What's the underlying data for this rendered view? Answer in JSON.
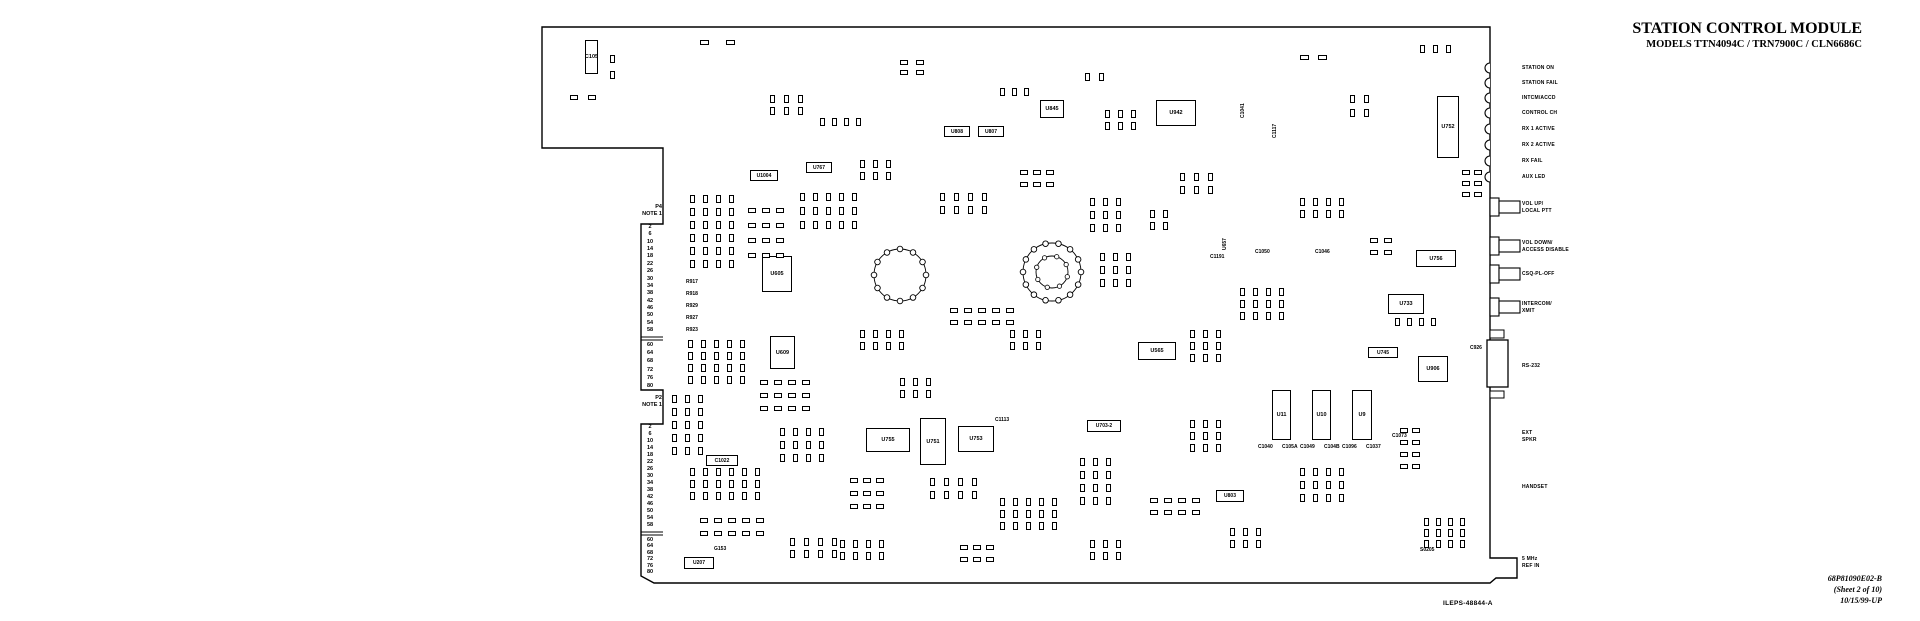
{
  "title": {
    "line1": "STATION CONTROL MODULE",
    "line2": "MODELS TTN4094C / TRN7900C / CLN6686C"
  },
  "footer": {
    "doc_number": "68P81090E02-B",
    "sheet": "(Sheet 2 of 10)",
    "date_rev": "10/15/99-UP",
    "drawing_ref": "ILEPS-48844-A"
  },
  "right_edge": {
    "leds": [
      {
        "label": "STATION ON",
        "y": 68
      },
      {
        "label": "STATION FAIL",
        "y": 83
      },
      {
        "label": "INTCM/ACCD",
        "y": 98
      },
      {
        "label": "CONTROL CH",
        "y": 113
      },
      {
        "label": "RX 1 ACTIVE",
        "y": 129
      },
      {
        "label": "RX 2 ACTIVE",
        "y": 145
      },
      {
        "label": "RX FAIL",
        "y": 161
      },
      {
        "label": "AUX LED",
        "y": 177
      }
    ],
    "buttons": [
      {
        "lines": [
          "VOL UP/",
          "LOCAL PTT"
        ],
        "y": 207
      },
      {
        "lines": [
          "VOL DOWN/",
          "ACCESS DISABLE"
        ],
        "y": 246
      },
      {
        "lines": [
          "CSQ-PL-OFF"
        ],
        "y": 274
      },
      {
        "lines": [
          "INTERCOM/",
          "XMIT"
        ],
        "y": 307
      }
    ],
    "connectors": [
      {
        "lines": [
          "RS-232"
        ],
        "y": 366
      },
      {
        "lines": [
          "EXT",
          "SPKR"
        ],
        "y": 436
      },
      {
        "lines": [
          "HANDSET"
        ],
        "y": 487
      },
      {
        "lines": [
          "5 MHz",
          "REF IN"
        ],
        "y": 562
      }
    ]
  },
  "left_edge": {
    "p4": {
      "name": "P4",
      "note": "NOTE 1",
      "label_y": 204,
      "top": 224,
      "bottom": 390,
      "sep_y": 338,
      "pins_a": [
        2,
        6,
        10,
        14,
        18,
        22,
        26,
        30,
        34,
        38,
        42,
        46,
        50,
        54,
        58
      ],
      "pins_b": [
        60,
        64,
        68,
        72,
        76,
        80
      ]
    },
    "p2": {
      "name": "P2",
      "note": "NOTE 1",
      "label_y": 395,
      "top": 424,
      "bottom": 576,
      "sep_y": 533,
      "pins_a": [
        2,
        6,
        10,
        14,
        18,
        22,
        26,
        30,
        34,
        38,
        42,
        46,
        50,
        54,
        58
      ],
      "pins_b": [
        60,
        64,
        68,
        72,
        76,
        80
      ]
    }
  },
  "components": [
    {
      "t": "icv",
      "x": 585,
      "y": 40,
      "w": 13,
      "h": 34,
      "label": "C105"
    },
    {
      "t": "ic",
      "x": 1156,
      "y": 100,
      "w": 40,
      "h": 26,
      "label": "U942"
    },
    {
      "t": "icv",
      "x": 1437,
      "y": 96,
      "w": 22,
      "h": 62,
      "label": "U752"
    },
    {
      "t": "ic",
      "x": 762,
      "y": 256,
      "w": 30,
      "h": 36,
      "label": "U605"
    },
    {
      "t": "icv",
      "x": 770,
      "y": 336,
      "w": 25,
      "h": 33,
      "label": "U609"
    },
    {
      "t": "box",
      "x": 806,
      "y": 162,
      "w": 26,
      "h": 11,
      "label": "U767"
    },
    {
      "t": "box",
      "x": 750,
      "y": 170,
      "w": 28,
      "h": 11,
      "label": "U1004"
    },
    {
      "t": "box",
      "x": 944,
      "y": 126,
      "w": 26,
      "h": 11,
      "label": "U808"
    },
    {
      "t": "box",
      "x": 978,
      "y": 126,
      "w": 26,
      "h": 11,
      "label": "U807"
    },
    {
      "t": "ic",
      "x": 1040,
      "y": 100,
      "w": 24,
      "h": 18,
      "label": "U845"
    },
    {
      "t": "ic",
      "x": 1416,
      "y": 250,
      "w": 40,
      "h": 17,
      "label": "U756"
    },
    {
      "t": "ic",
      "x": 1388,
      "y": 294,
      "w": 36,
      "h": 20,
      "label": "U733"
    },
    {
      "t": "box",
      "x": 1368,
      "y": 347,
      "w": 30,
      "h": 11,
      "label": "U745"
    },
    {
      "t": "ic",
      "x": 1418,
      "y": 356,
      "w": 30,
      "h": 26,
      "label": "U906"
    },
    {
      "t": "ic",
      "x": 1138,
      "y": 342,
      "w": 38,
      "h": 18,
      "label": "U565"
    },
    {
      "t": "icv",
      "x": 1272,
      "y": 390,
      "w": 19,
      "h": 50,
      "label": "U11"
    },
    {
      "t": "icv",
      "x": 1312,
      "y": 390,
      "w": 19,
      "h": 50,
      "label": "U10"
    },
    {
      "t": "icv",
      "x": 1352,
      "y": 390,
      "w": 20,
      "h": 50,
      "label": "U9"
    },
    {
      "t": "ic",
      "x": 866,
      "y": 428,
      "w": 44,
      "h": 24,
      "label": "U755"
    },
    {
      "t": "icv",
      "x": 920,
      "y": 418,
      "w": 26,
      "h": 47,
      "label": "U751"
    },
    {
      "t": "ic",
      "x": 958,
      "y": 426,
      "w": 36,
      "h": 26,
      "label": "U753"
    },
    {
      "t": "box",
      "x": 1087,
      "y": 420,
      "w": 34,
      "h": 12,
      "label": "U703-2"
    },
    {
      "t": "box",
      "x": 1216,
      "y": 490,
      "w": 28,
      "h": 12,
      "label": "U803"
    },
    {
      "t": "box",
      "x": 684,
      "y": 557,
      "w": 30,
      "h": 12,
      "label": "U207"
    },
    {
      "t": "box",
      "x": 706,
      "y": 455,
      "w": 32,
      "h": 11,
      "label": "C1022"
    },
    {
      "t": "txt",
      "x": 1258,
      "y": 444,
      "label": "C1040"
    },
    {
      "t": "txt",
      "x": 1282,
      "y": 444,
      "label": "C105A"
    },
    {
      "t": "txt",
      "x": 1300,
      "y": 444,
      "label": "C1049"
    },
    {
      "t": "txt",
      "x": 1324,
      "y": 444,
      "label": "C104B"
    },
    {
      "t": "txt",
      "x": 1342,
      "y": 444,
      "label": "C1096"
    },
    {
      "t": "txt",
      "x": 1366,
      "y": 444,
      "label": "C1037"
    },
    {
      "t": "vtxt",
      "x": 1240,
      "y": 118,
      "label": "C1041"
    },
    {
      "t": "vtxt",
      "x": 1272,
      "y": 138,
      "label": "C1117"
    },
    {
      "t": "vtxt",
      "x": 1222,
      "y": 250,
      "label": "U657"
    },
    {
      "t": "txt",
      "x": 1210,
      "y": 254,
      "label": "C1191"
    },
    {
      "t": "txt",
      "x": 1255,
      "y": 249,
      "label": "C1050"
    },
    {
      "t": "txt",
      "x": 1315,
      "y": 249,
      "label": "C1046"
    },
    {
      "t": "txt",
      "x": 1470,
      "y": 345,
      "label": "C926"
    },
    {
      "t": "txt",
      "x": 686,
      "y": 279,
      "label": "R917"
    },
    {
      "t": "txt",
      "x": 686,
      "y": 291,
      "label": "R918"
    },
    {
      "t": "txt",
      "x": 686,
      "y": 303,
      "label": "R929"
    },
    {
      "t": "txt",
      "x": 686,
      "y": 315,
      "label": "R927"
    },
    {
      "t": "txt",
      "x": 686,
      "y": 327,
      "label": "R923"
    },
    {
      "t": "txt",
      "x": 714,
      "y": 546,
      "label": "G153"
    },
    {
      "t": "txt",
      "x": 1420,
      "y": 547,
      "label": "S0205"
    },
    {
      "t": "txt",
      "x": 995,
      "y": 417,
      "label": "C1113"
    },
    {
      "t": "txt",
      "x": 1392,
      "y": 433,
      "label": "C1073"
    }
  ],
  "pad_clusters": [
    [
      700,
      40,
      2,
      1,
      26,
      0,
      9,
      5
    ],
    [
      610,
      55,
      1,
      2,
      0,
      16,
      5,
      8
    ],
    [
      570,
      95,
      2,
      1,
      18,
      0,
      8,
      5
    ],
    [
      770,
      95,
      3,
      2,
      14,
      12,
      5,
      8
    ],
    [
      820,
      118,
      4,
      1,
      12,
      0,
      5,
      8
    ],
    [
      900,
      60,
      2,
      2,
      16,
      10,
      8,
      5
    ],
    [
      1000,
      88,
      3,
      1,
      12,
      0,
      5,
      8
    ],
    [
      1085,
      73,
      2,
      1,
      14,
      0,
      5,
      8
    ],
    [
      1105,
      110,
      3,
      2,
      13,
      12,
      5,
      8
    ],
    [
      1300,
      55,
      2,
      1,
      18,
      0,
      9,
      5
    ],
    [
      1350,
      95,
      2,
      2,
      14,
      14,
      5,
      8
    ],
    [
      1420,
      45,
      3,
      1,
      13,
      0,
      5,
      8
    ],
    [
      1462,
      170,
      2,
      3,
      12,
      11,
      8,
      5
    ],
    [
      690,
      195,
      4,
      6,
      13,
      13,
      5,
      8
    ],
    [
      748,
      208,
      3,
      4,
      14,
      15,
      8,
      5
    ],
    [
      800,
      193,
      5,
      3,
      13,
      14,
      5,
      8
    ],
    [
      688,
      340,
      5,
      4,
      13,
      12,
      5,
      8
    ],
    [
      760,
      380,
      4,
      3,
      14,
      13,
      8,
      5
    ],
    [
      940,
      193,
      4,
      2,
      14,
      13,
      5,
      8
    ],
    [
      1090,
      198,
      3,
      3,
      13,
      13,
      5,
      8
    ],
    [
      950,
      308,
      5,
      2,
      14,
      12,
      8,
      5
    ],
    [
      1100,
      253,
      3,
      3,
      13,
      13,
      5,
      8
    ],
    [
      1180,
      173,
      3,
      2,
      14,
      13,
      5,
      8
    ],
    [
      1300,
      198,
      4,
      2,
      13,
      12,
      5,
      8
    ],
    [
      1370,
      238,
      2,
      2,
      14,
      12,
      8,
      5
    ],
    [
      1240,
      288,
      4,
      3,
      13,
      12,
      5,
      8
    ],
    [
      1395,
      318,
      4,
      1,
      12,
      0,
      5,
      8
    ],
    [
      672,
      395,
      3,
      5,
      13,
      13,
      5,
      8
    ],
    [
      690,
      468,
      6,
      3,
      13,
      12,
      5,
      8
    ],
    [
      700,
      518,
      5,
      2,
      14,
      13,
      8,
      5
    ],
    [
      780,
      428,
      4,
      3,
      13,
      13,
      5,
      8
    ],
    [
      790,
      538,
      4,
      2,
      14,
      12,
      5,
      8
    ],
    [
      850,
      478,
      3,
      3,
      13,
      13,
      8,
      5
    ],
    [
      930,
      478,
      4,
      2,
      14,
      13,
      5,
      8
    ],
    [
      1000,
      498,
      5,
      3,
      13,
      12,
      5,
      8
    ],
    [
      1080,
      458,
      3,
      4,
      13,
      13,
      5,
      8
    ],
    [
      1150,
      498,
      4,
      2,
      14,
      12,
      8,
      5
    ],
    [
      1230,
      528,
      3,
      2,
      13,
      12,
      5,
      8
    ],
    [
      1300,
      468,
      4,
      3,
      13,
      13,
      5,
      8
    ],
    [
      1400,
      428,
      2,
      4,
      12,
      12,
      8,
      5
    ],
    [
      1424,
      518,
      4,
      3,
      12,
      11,
      5,
      8
    ],
    [
      900,
      378,
      3,
      2,
      13,
      12,
      5,
      8
    ],
    [
      860,
      160,
      3,
      2,
      13,
      12,
      5,
      8
    ],
    [
      1020,
      170,
      3,
      2,
      13,
      12,
      8,
      5
    ],
    [
      1150,
      210,
      2,
      2,
      13,
      12,
      5,
      8
    ],
    [
      860,
      330,
      4,
      2,
      13,
      12,
      5,
      8
    ],
    [
      1010,
      330,
      3,
      2,
      13,
      12,
      5,
      8
    ],
    [
      1190,
      330,
      3,
      3,
      13,
      12,
      5,
      8
    ],
    [
      1190,
      420,
      3,
      3,
      13,
      12,
      5,
      8
    ],
    [
      840,
      540,
      4,
      2,
      13,
      12,
      5,
      8
    ],
    [
      960,
      545,
      3,
      2,
      13,
      12,
      8,
      5
    ],
    [
      1090,
      540,
      3,
      2,
      13,
      12,
      5,
      8
    ]
  ],
  "rings": [
    {
      "cx": 900,
      "cy": 275,
      "r": 26,
      "pads": 12,
      "inner": 0
    },
    {
      "cx": 1052,
      "cy": 272,
      "r": 29,
      "pads": 14,
      "inner": 16
    }
  ]
}
